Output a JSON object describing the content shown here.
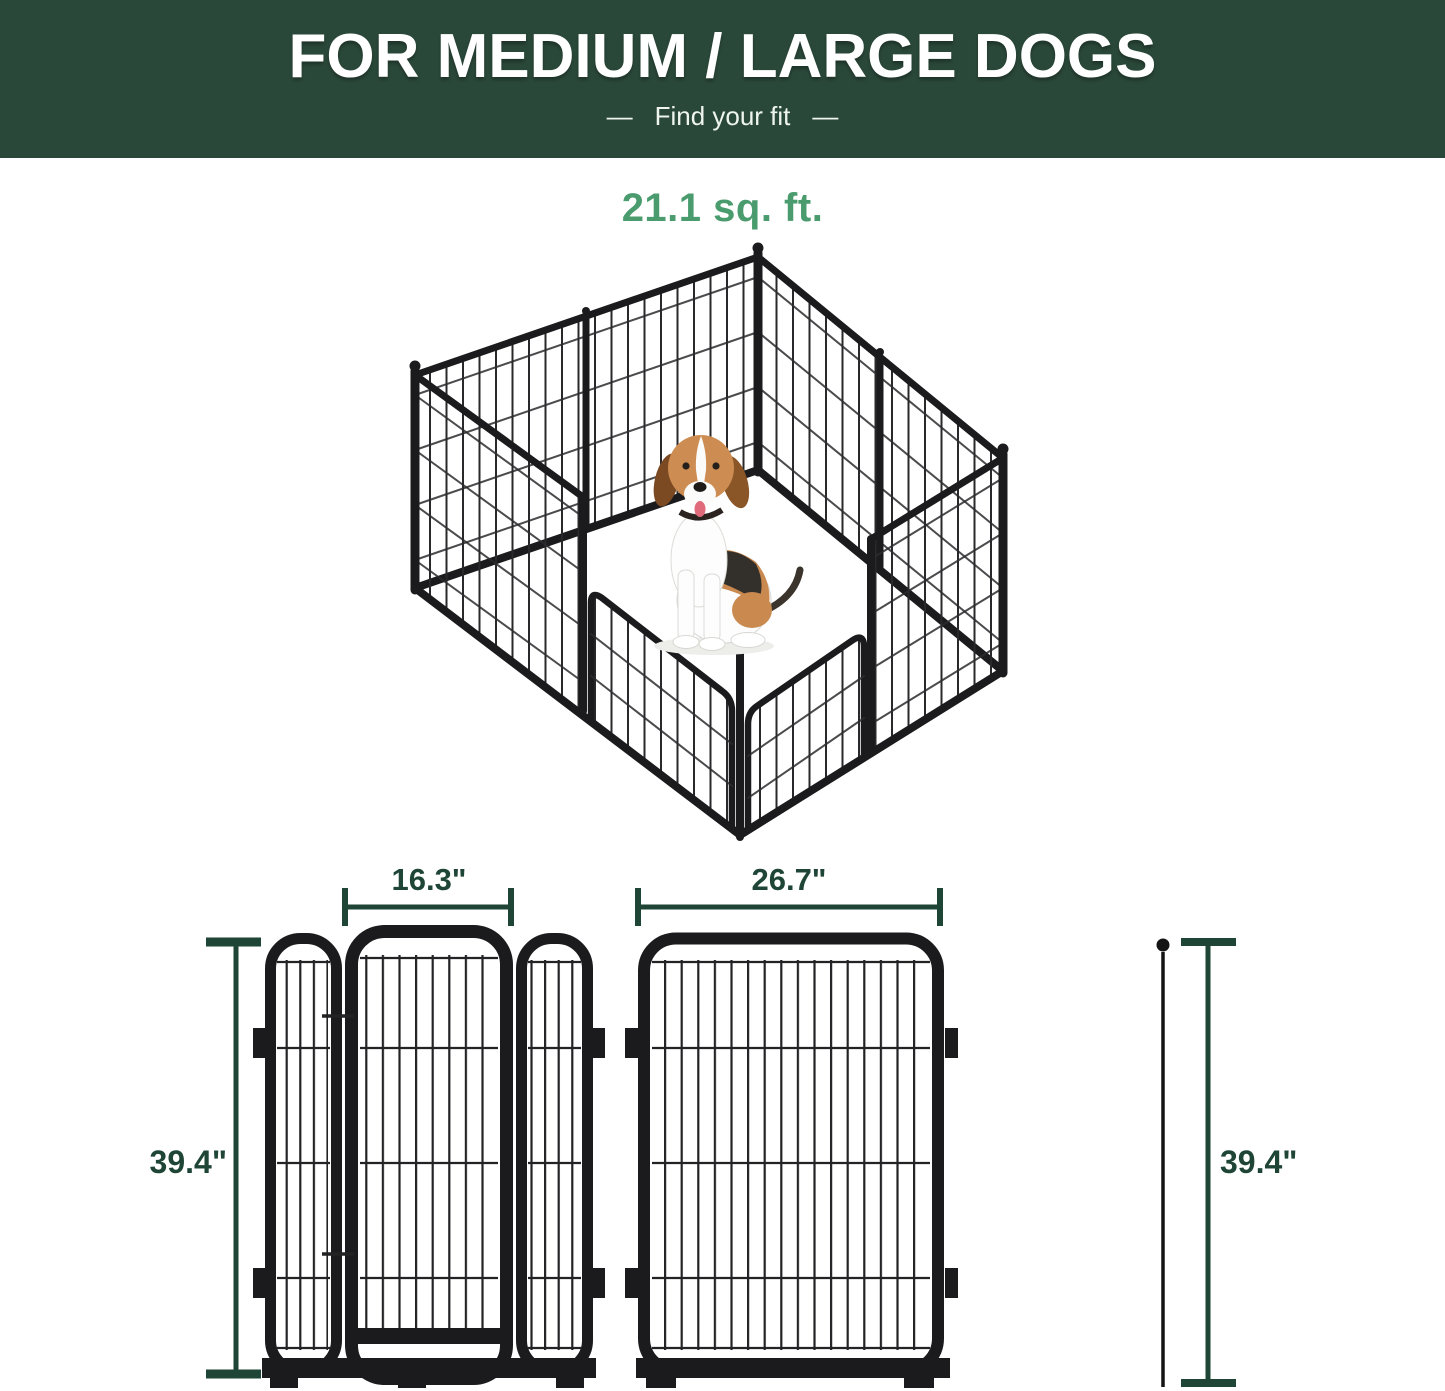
{
  "banner": {
    "title": "FOR MEDIUM / LARGE DOGS",
    "dash_left": "—",
    "subtitle": "Find your fit",
    "dash_right": "—"
  },
  "playpen_illustration": {
    "area_label": "21.1 sq. ft."
  },
  "dimension_diagrams": {
    "door_section_width": "16.3\"",
    "single_panel_width": "26.7\"",
    "left_height": "39.4\"",
    "right_height": "39.4\""
  },
  "colors": {
    "banner_background": "#2a4839",
    "banner_text": "#ffffff",
    "area_label_green": "#4a9b6e",
    "dimension_green": "#1e4536",
    "metal_frame": "#1b1b1d"
  }
}
